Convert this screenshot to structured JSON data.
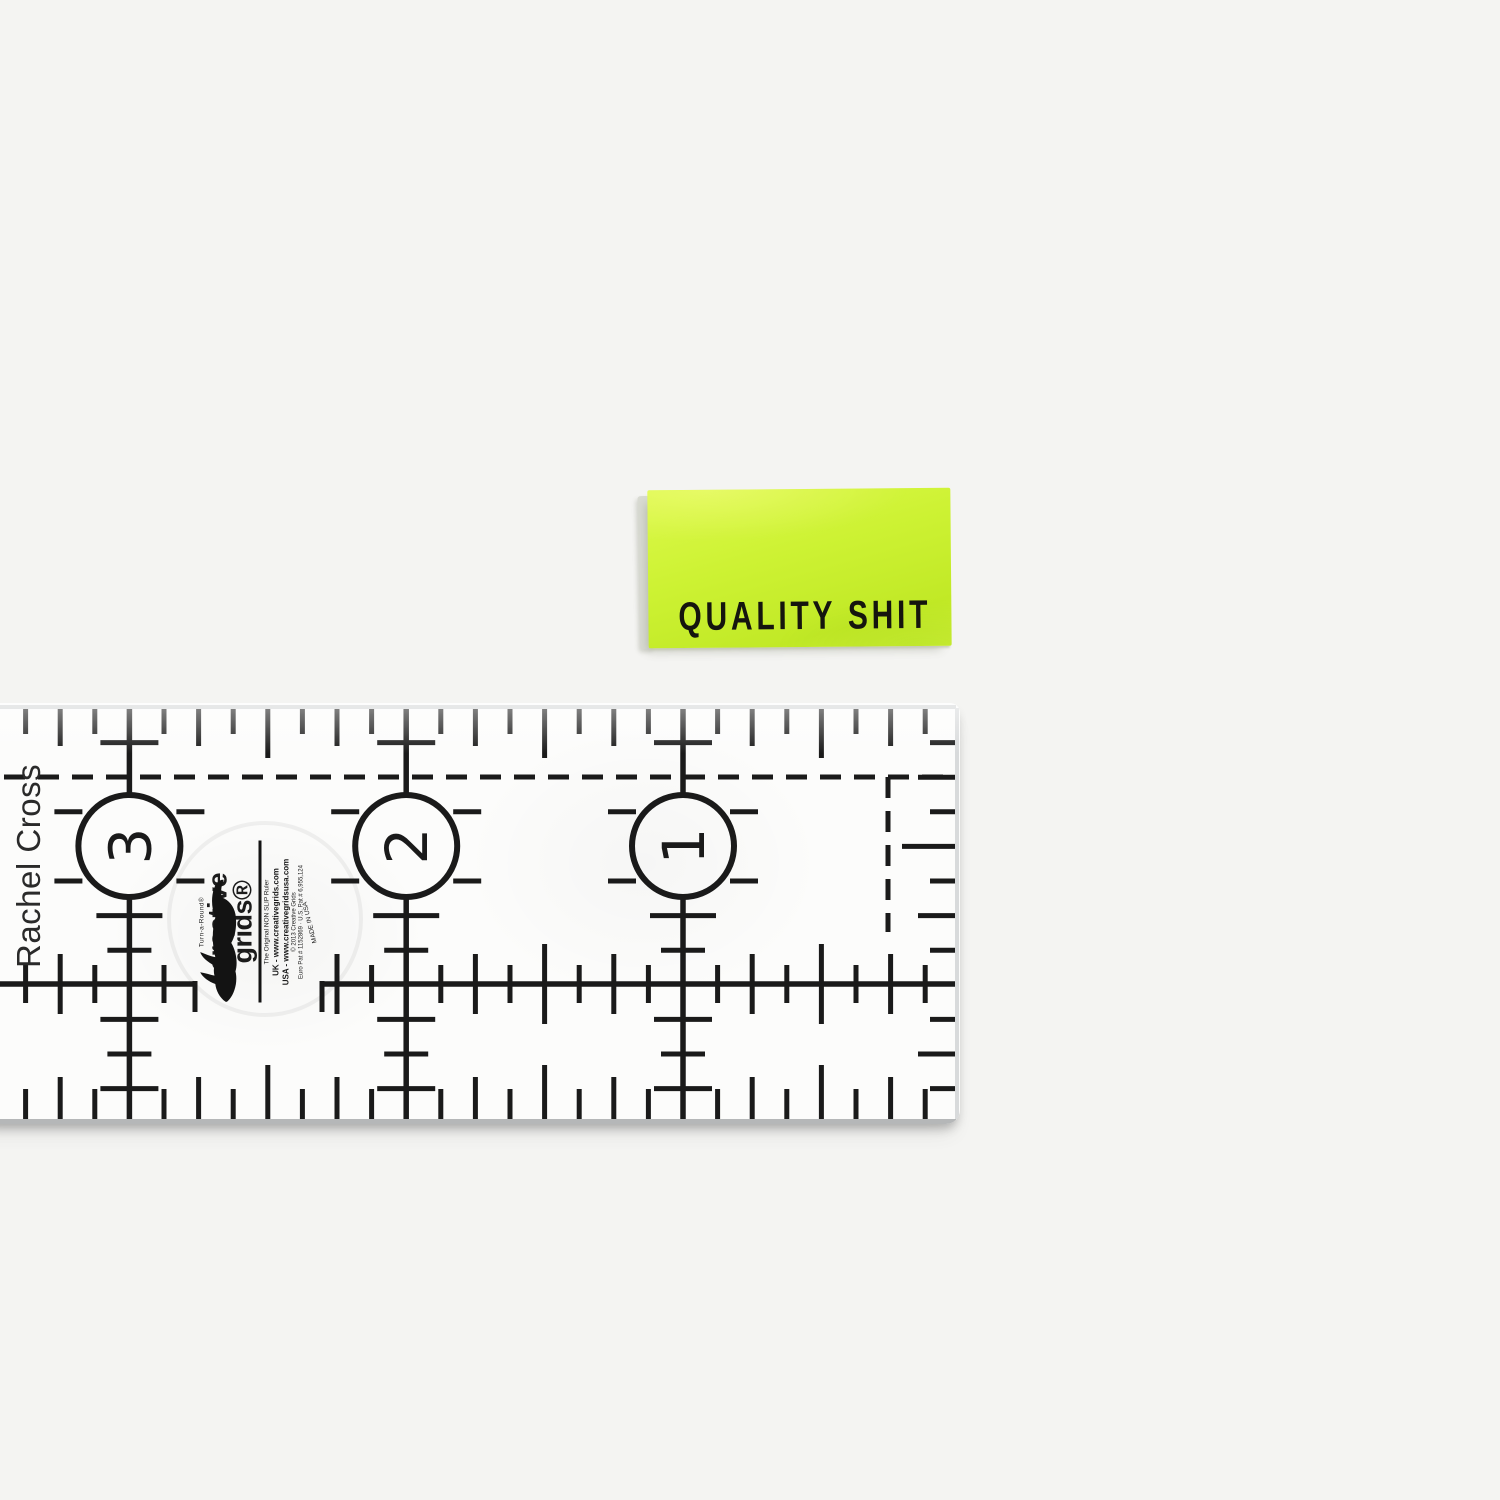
{
  "page": {
    "background": "#f4f4f2"
  },
  "label": {
    "text": "QUALITY SHIT",
    "text_color": "#15150e",
    "green_light": "#dcf94a",
    "green": "#cdf233",
    "green_deep": "#c1e926",
    "fold_color": "#d9dbd3"
  },
  "ruler": {
    "name_text": "Rachel Cross",
    "ink": "#1a1a1a",
    "face": "#fcfcfb",
    "brand": {
      "turn": "Turn-a-Round®",
      "line1": "creative",
      "line2": "grids®",
      "tagline": "The Original NON SLIP Ruler",
      "uk": "UK - www.creativegrids.com",
      "usa": "USA - www.creativegridsusa.com",
      "copyright": "© 2013 Creative Grids",
      "patents": "Euro Pat # 1152869 · U.S. Pat # 6,955,124",
      "made": "MADE IN USA"
    },
    "config": {
      "w": 990,
      "h": 421,
      "right": 986,
      "top": 5,
      "bottom": 416,
      "eighth": 34.6,
      "anchor_x": 713,
      "j_min": -20,
      "j_max": 7,
      "inch_lines": [
        {
          "label": "1",
          "x": 713
        },
        {
          "label": "2",
          "x": 436.2
        },
        {
          "label": "3",
          "x": 159.4
        }
      ],
      "circle_cy": 143,
      "circle_r": 51,
      "digit_size": 58,
      "dash_h_y": 74,
      "dash_v": {
        "x": 918,
        "y1": 74,
        "y2": 229
      },
      "mid_y": 281,
      "mid_gap": [
        225,
        352
      ],
      "hook": 28,
      "dash": [
        21,
        13
      ],
      "stroke": 5,
      "line_stroke": 5.5,
      "top_tick": {
        "e": 26,
        "q": 38,
        "h": 50
      },
      "bottom_tick": {
        "e": 30,
        "q": 42,
        "h": 54
      },
      "right_tick": {
        "e": 26,
        "q": 38,
        "h": 54
      },
      "cross_tick": {
        "e": 19,
        "q": 30,
        "h": 40
      },
      "bars": [
        {
          "k": 1,
          "t": "m"
        },
        {
          "k": 6,
          "t": "q"
        },
        {
          "k": 7,
          "t": "s"
        },
        {
          "k": 9,
          "t": "m"
        },
        {
          "k": 10,
          "t": "s"
        },
        {
          "k": 11,
          "t": "m"
        }
      ],
      "bar_w": {
        "s": 44,
        "m": 58,
        "q": 66
      },
      "side_tick_ks": [
        3,
        5
      ],
      "watermark": {
        "cx": 295,
        "cy": 216,
        "r": 96
      },
      "edges": {
        "top": "#d2d4d5",
        "right": "#d8dadb",
        "bottom": "#b5b7b8"
      }
    }
  }
}
